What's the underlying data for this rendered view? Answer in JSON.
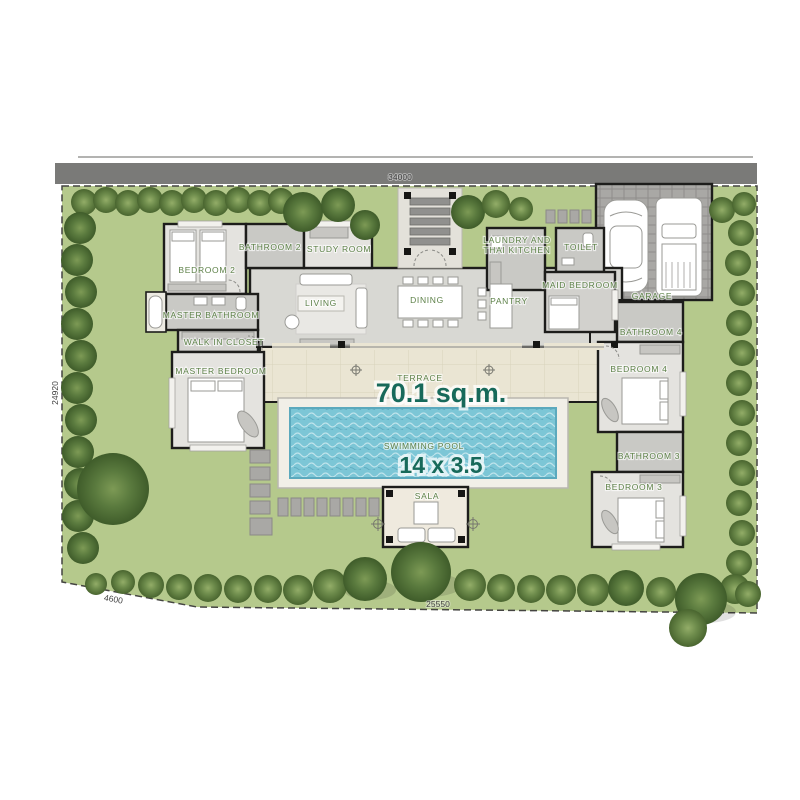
{
  "plan": {
    "dimensions": {
      "top": "34000",
      "left": "24920",
      "bottom_left": "4600",
      "bottom": "25550"
    },
    "rooms": {
      "bedroom2": "BEDROOM 2",
      "bathroom2": "BATHROOM 2",
      "study_room": "STUDY ROOM",
      "living": "LIVING",
      "dining": "DINING",
      "pantry": "PANTRY",
      "laundry_line1": "LAUNDRY AND",
      "laundry_line2": "THAI KITCHEN",
      "toilet": "TOILET",
      "maid_bedroom": "MAID BEDROOM",
      "garage": "GARAGE",
      "master_bathroom": "MASTER BATHROOM",
      "walk_in_closet": "WALK IN CLOSET",
      "master_bedroom": "MASTER BEDROOM",
      "terrace": "TERRACE",
      "terrace_area": "70.1 sq.m.",
      "swimming_pool": "SWIMMING POOL",
      "pool_size": "14 x 3.5",
      "sala": "SALA",
      "bathroom4": "BATHROOM 4",
      "bedroom4": "BEDROOM 4",
      "bathroom3": "BATHROOM 3",
      "bedroom3": "BEDROOM 3"
    },
    "colors": {
      "label_green": "#5d8148",
      "number_teal": "#17695a",
      "pool_blue": "#7cc6d6",
      "grass_green": "#b5c98c",
      "road_gray": "#7a7a78",
      "wall_black": "#1d1d1b"
    }
  }
}
